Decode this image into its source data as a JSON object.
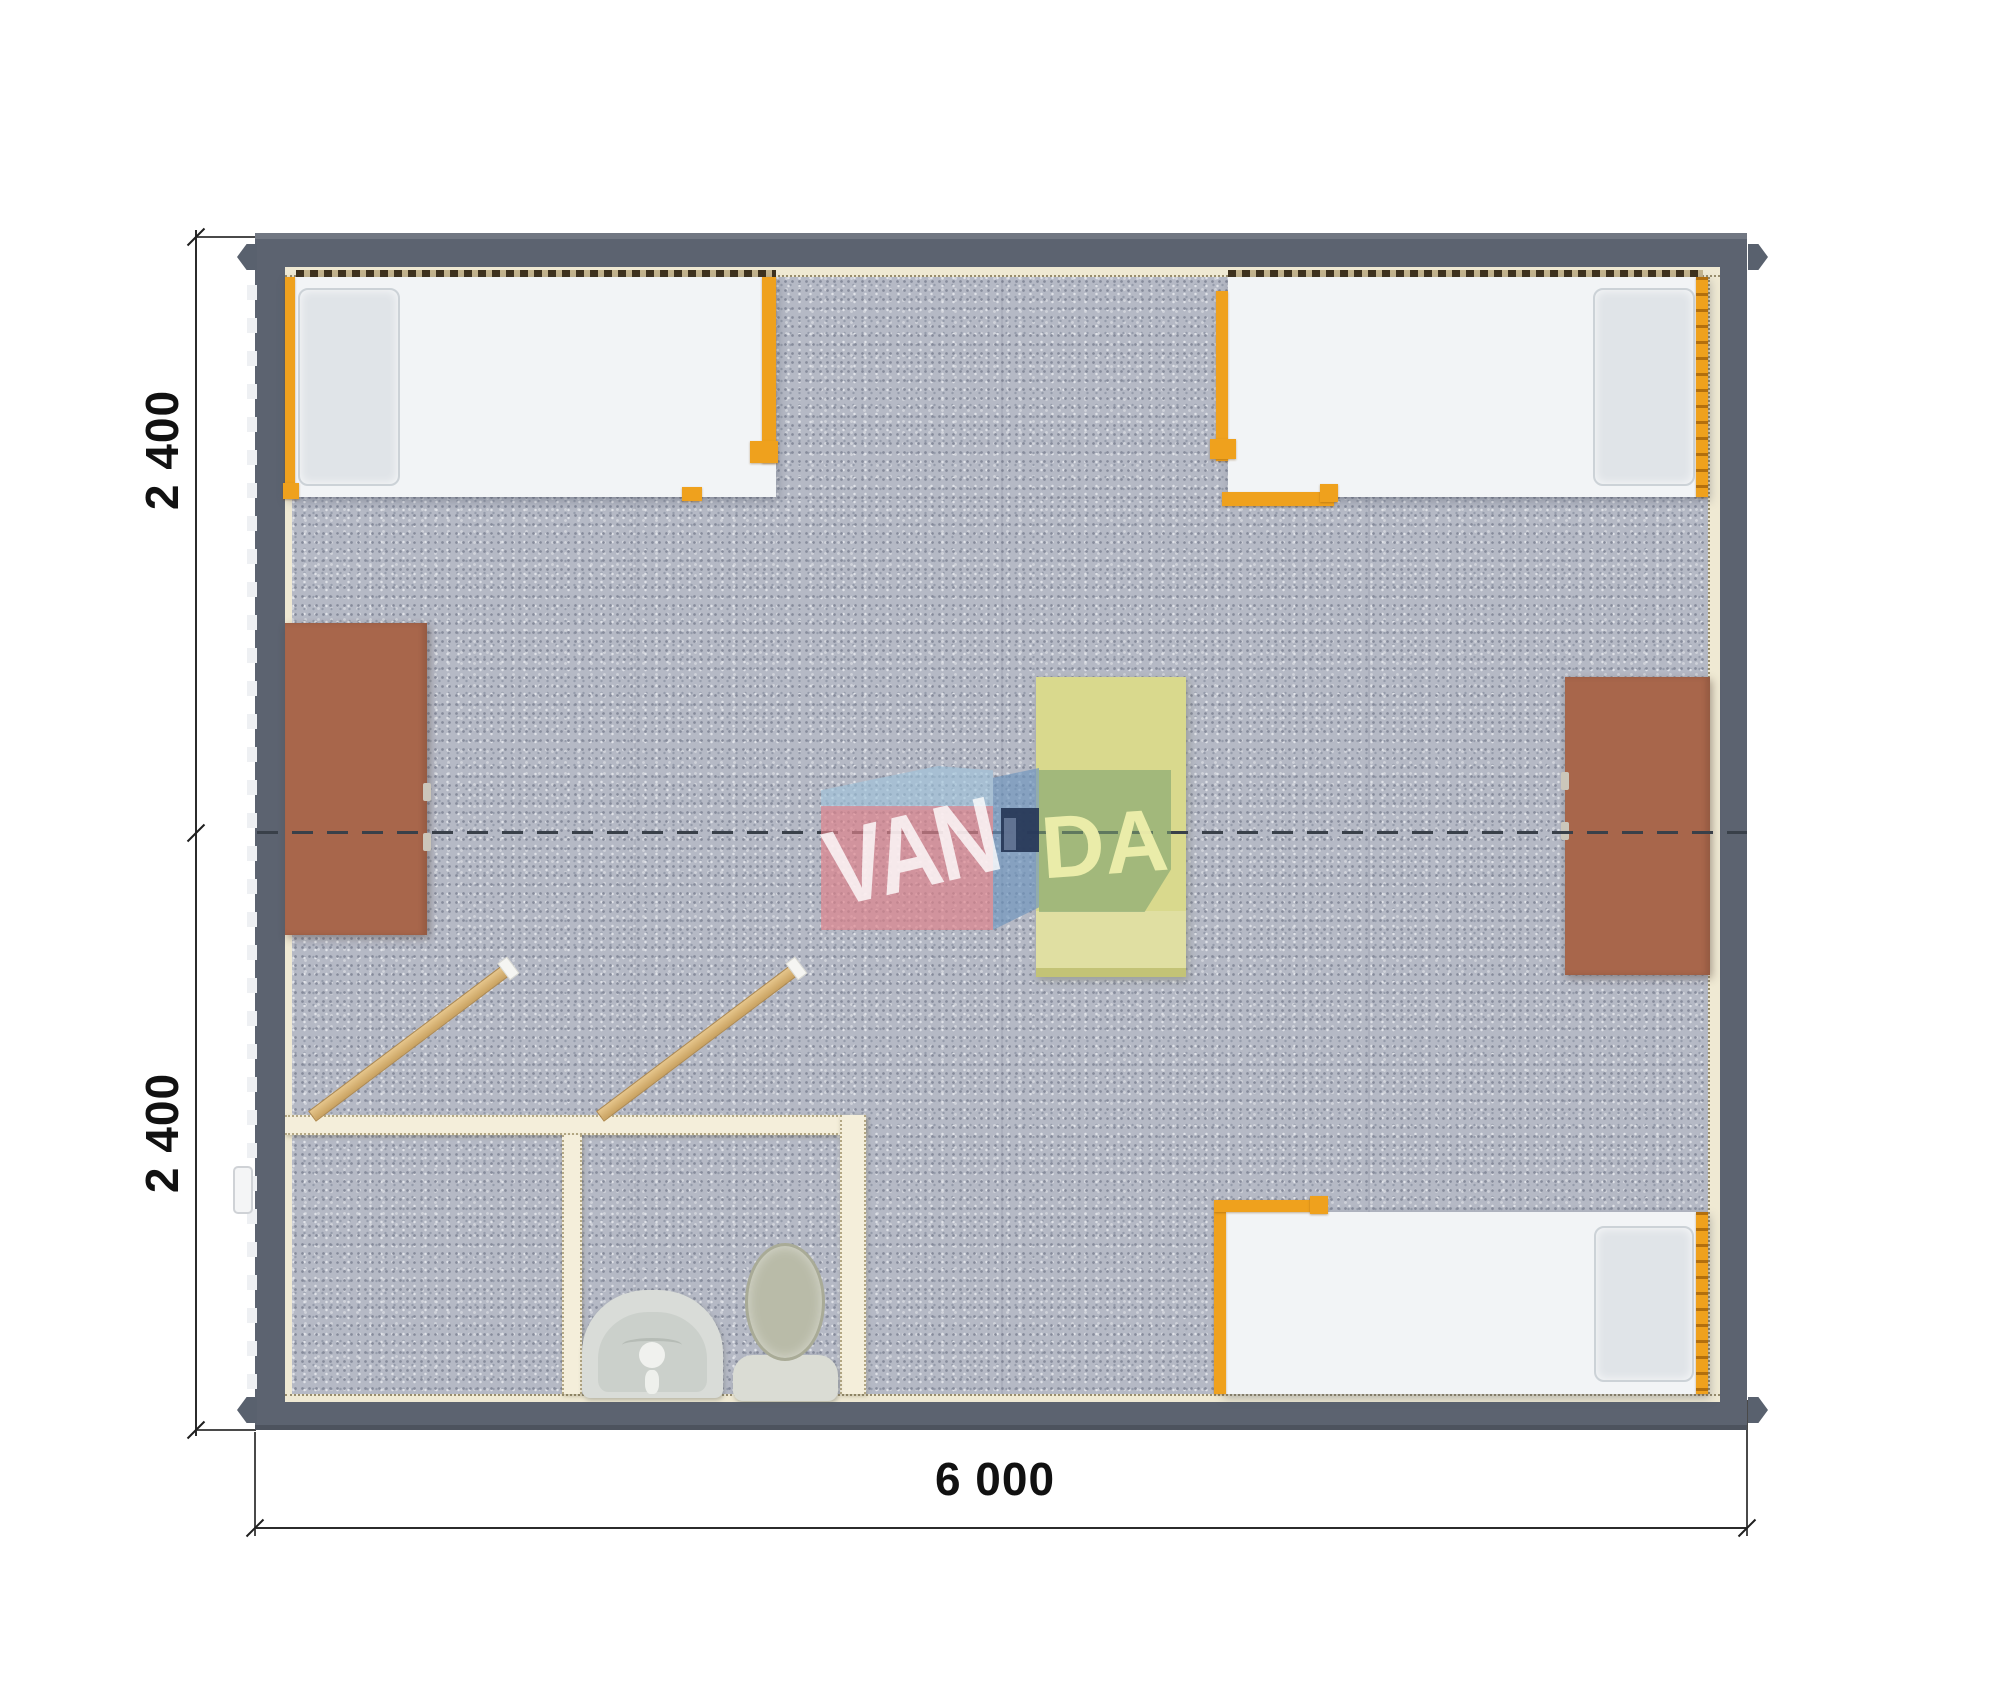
{
  "page": {
    "kind": "3d-rendered modular building floor plan (top view)",
    "background": "#ffffff"
  },
  "dimensions": {
    "left_top_label": "2 400",
    "left_bottom_label": "2 400",
    "bottom_label": "6 000"
  },
  "watermark": {
    "brand": "VANDA",
    "text_left": "VAN",
    "text_right": "DA"
  },
  "contents": {
    "beds": 3,
    "desks": 2,
    "center_table": 1,
    "partition_rooms": 2,
    "toilet": 1,
    "sink": 1,
    "open_doors": 2
  },
  "palette": {
    "wall_gray": "#5c6370",
    "floor_carpet": "#b5b9c5",
    "frame_orange": "#efa11d",
    "bed_white": "#f2f4f6",
    "pillow_gray": "#e0e4e8",
    "desk_brown": "#a8664b",
    "table_yellow": "#d9d98d",
    "partition_cream": "#f4eeda",
    "door_tan": "#d9b87b",
    "dimension_ink": "#1f1f1f",
    "logo_pink": "#de828a",
    "logo_blue": "#6e94be",
    "logo_navy": "#263656",
    "logo_green": "#7aa06e",
    "logo_letters_yellow": "#eeeeac"
  }
}
